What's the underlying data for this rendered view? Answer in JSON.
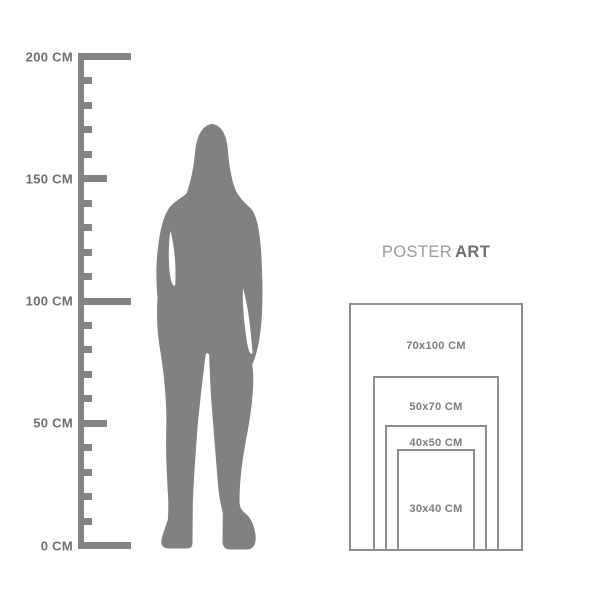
{
  "colors": {
    "background": "#ffffff",
    "figure": "#818181",
    "ruler": "#838383",
    "ruler_label": "#6f6f6f",
    "frame_border": "#8c8c8c",
    "frame_label": "#7c7c7c",
    "brand_regular": "#9b9b9b",
    "brand_bold": "#6e6e6e"
  },
  "ruler": {
    "unit": "CM",
    "min_cm": 0,
    "max_cm": 200,
    "minor_step_cm": 10,
    "major_step_cm": 50,
    "labels": [
      {
        "cm": 200,
        "text": "200 CM"
      },
      {
        "cm": 150,
        "text": "150 CM"
      },
      {
        "cm": 100,
        "text": "100 CM"
      },
      {
        "cm": 50,
        "text": "50 CM"
      },
      {
        "cm": 0,
        "text": "0 CM"
      }
    ]
  },
  "figure": {
    "name": "woman-silhouette",
    "color": "#818181"
  },
  "brand": {
    "regular": "POSTER",
    "bold": "ART"
  },
  "poster_sizes": [
    {
      "label": "70x100 CM",
      "width_cm": 70,
      "height_cm": 100
    },
    {
      "label": "50x70 CM",
      "width_cm": 50,
      "height_cm": 70
    },
    {
      "label": "40x50 CM",
      "width_cm": 40,
      "height_cm": 50
    },
    {
      "label": "30x40 CM",
      "width_cm": 30,
      "height_cm": 40
    }
  ]
}
